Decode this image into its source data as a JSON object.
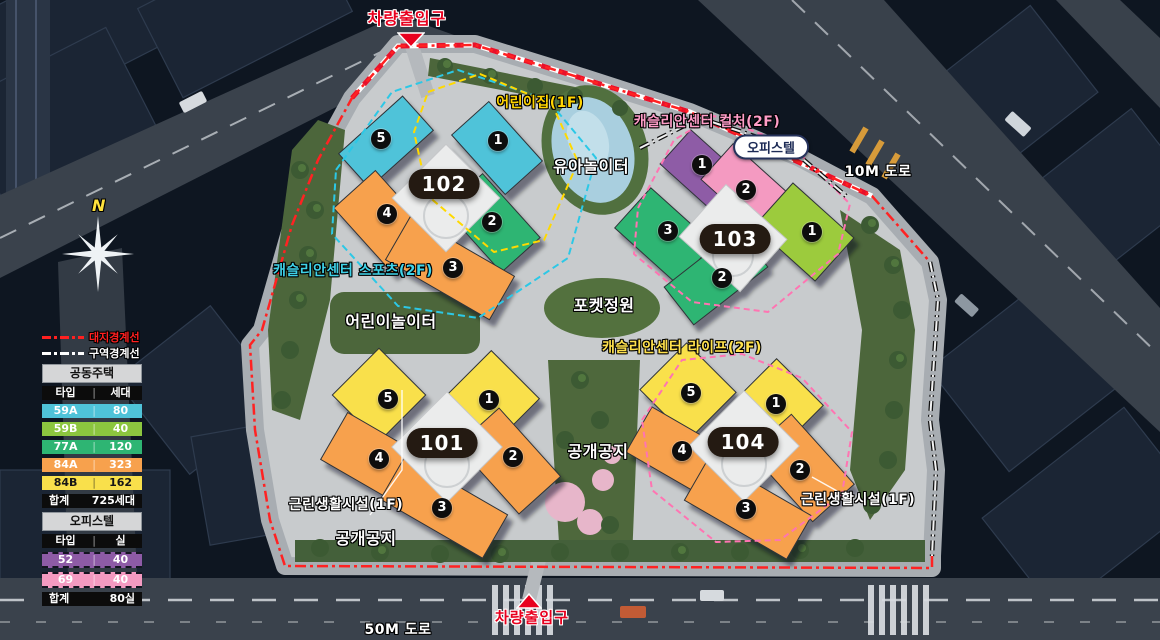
{
  "legend": {
    "boundary_lines": [
      {
        "label": "대지경계선",
        "color": "#ff2020",
        "style": "red-dash-dot"
      },
      {
        "label": "구역경계선",
        "color": "#ffffff",
        "style": "white-dash-dot"
      }
    ],
    "housing": {
      "title": "공동주택",
      "columns": {
        "type": "타입",
        "divider": "|",
        "count": "세대"
      },
      "rows": [
        {
          "type": "59A",
          "divider": "|",
          "count": "80",
          "color": "#4fc3d9"
        },
        {
          "type": "59B",
          "divider": "|",
          "count": "40",
          "color": "#8cc63f"
        },
        {
          "type": "77A",
          "divider": "|",
          "count": "120",
          "color": "#2eb573"
        },
        {
          "type": "84A",
          "divider": "|",
          "count": "323",
          "color": "#f7a14d"
        },
        {
          "type": "84B",
          "divider": "|",
          "count": "162",
          "color": "#f9e04b"
        }
      ],
      "total": {
        "label": "합계",
        "value": "725세대"
      }
    },
    "officetel": {
      "title": "오피스텔",
      "columns": {
        "type": "타입",
        "divider": "|",
        "count": "실"
      },
      "rows": [
        {
          "type": "52",
          "divider": "|",
          "count": "40",
          "color": "#8e5ba6"
        },
        {
          "type": "69",
          "divider": "|",
          "count": "40",
          "color": "#f49ac1"
        }
      ],
      "total": {
        "label": "합계",
        "value": "80실"
      }
    }
  },
  "compass": {
    "label": "N"
  },
  "labels": {
    "entrance": "차량출입구",
    "daycare": "어린이집(1F)",
    "center_culture": "캐슬리안센터 컬처(2F)",
    "officetel": "오피스텔",
    "road_10m": "10M 도로",
    "toddler_playground": "유아놀이터",
    "center_sports": "캐슬리안센터 스포츠(2F)",
    "children_playground": "어린이놀이터",
    "pocket_garden": "포켓정원",
    "center_life": "캐슬리안센터 라이프(2F)",
    "open_space": "공개공지",
    "neighborhood_facility": "근린생활시설(1F)",
    "road_50m": "50M 도로"
  },
  "buildings": [
    {
      "number": "101",
      "units": [
        {
          "n": "5",
          "color": "#f9e04b"
        },
        {
          "n": "1",
          "color": "#f9e04b"
        },
        {
          "n": "4",
          "color": "#f7a14d"
        },
        {
          "n": "2",
          "color": "#f7a14d"
        },
        {
          "n": "3",
          "color": "#f7a14d"
        }
      ]
    },
    {
      "number": "102",
      "units": [
        {
          "n": "5",
          "color": "#4fc3d9"
        },
        {
          "n": "1",
          "color": "#4fc3d9"
        },
        {
          "n": "4",
          "color": "#f7a14d"
        },
        {
          "n": "2",
          "color": "#2eb573"
        },
        {
          "n": "3",
          "color": "#f7a14d"
        }
      ]
    },
    {
      "number": "103",
      "units": [
        {
          "n": "1",
          "color": "#8e5ba6"
        },
        {
          "n": "2",
          "color": "#f49ac1"
        },
        {
          "n": "3",
          "color": "#2eb573"
        },
        {
          "n": "2",
          "color": "#2eb573"
        },
        {
          "n": "1",
          "color": "#9ccb3c"
        }
      ]
    },
    {
      "number": "104",
      "units": [
        {
          "n": "5",
          "color": "#f9e04b"
        },
        {
          "n": "1",
          "color": "#f9e04b"
        },
        {
          "n": "4",
          "color": "#f7a14d"
        },
        {
          "n": "2",
          "color": "#f7a14d"
        },
        {
          "n": "3",
          "color": "#f7a14d"
        }
      ]
    }
  ]
}
